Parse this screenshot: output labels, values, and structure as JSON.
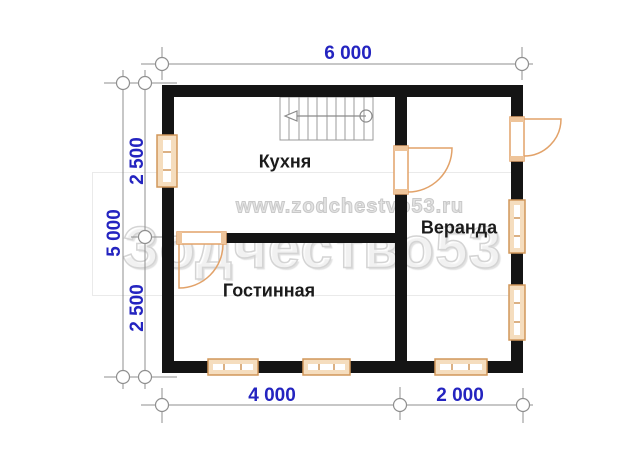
{
  "plan": {
    "rooms": {
      "kitchen": "Кухня",
      "veranda": "Веранда",
      "living_room": "Гостинная"
    },
    "dimensions": {
      "top_width": "6 000",
      "left_total": "5 000",
      "left_upper": "2 500",
      "left_lower": "2 500",
      "bottom_left": "4 000",
      "bottom_right": "2 000"
    },
    "watermark": {
      "url": "www.zodchestvo53.ru",
      "brand": "Зодчество53"
    },
    "colors": {
      "wall": "#141414",
      "dimension_text": "#2424c0",
      "dimension_line": "#8f8f8f",
      "window_fill": "#f5ddbe",
      "window_border": "#d1975a",
      "door": "#e2a269",
      "watermark_gray": "#d4d4d4"
    }
  }
}
